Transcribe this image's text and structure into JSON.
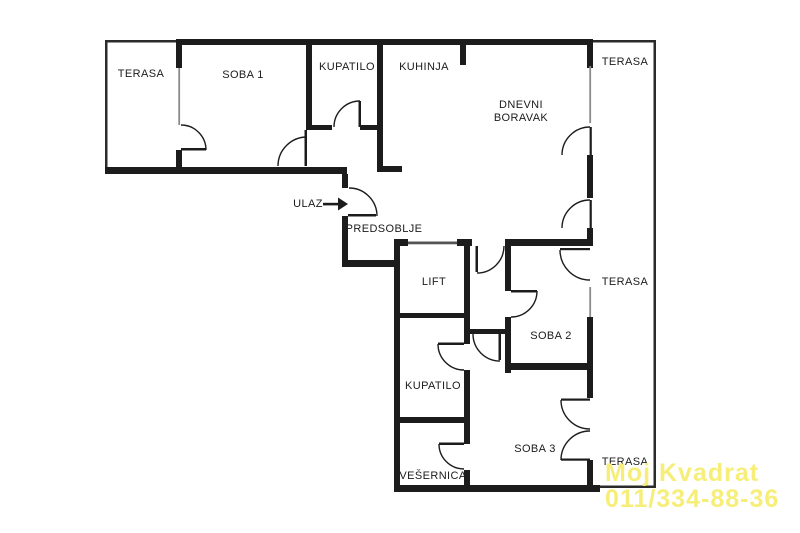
{
  "rooms": {
    "terasa_top_left": "TERASA",
    "soba1": "SOBA 1",
    "kupatilo_top": "KUPATILO",
    "kuhinja": "KUHINJA",
    "dnevni_boravak": "DNEVNI BORAVAK",
    "terasa_top_right": "TERASA",
    "ulaz": "ULAZ",
    "predsoblje": "PREDSOBLJE",
    "lift": "LIFT",
    "soba2": "SOBA 2",
    "terasa_mid_right": "TERASA",
    "kupatilo_bottom": "KUPATILO",
    "soba3": "SOBA 3",
    "vesernica": "VEŠERNICA",
    "terasa_bottom_right": "TERASA"
  },
  "watermark": {
    "line1": "Moj Kvadrat",
    "line2": "011/334-88-36"
  },
  "colors": {
    "wall": "#1c1c1c",
    "window": "#8a8a8a",
    "terrace_outline": "#2b2b2b",
    "watermark": "#f6ee78",
    "background": "#ffffff"
  }
}
